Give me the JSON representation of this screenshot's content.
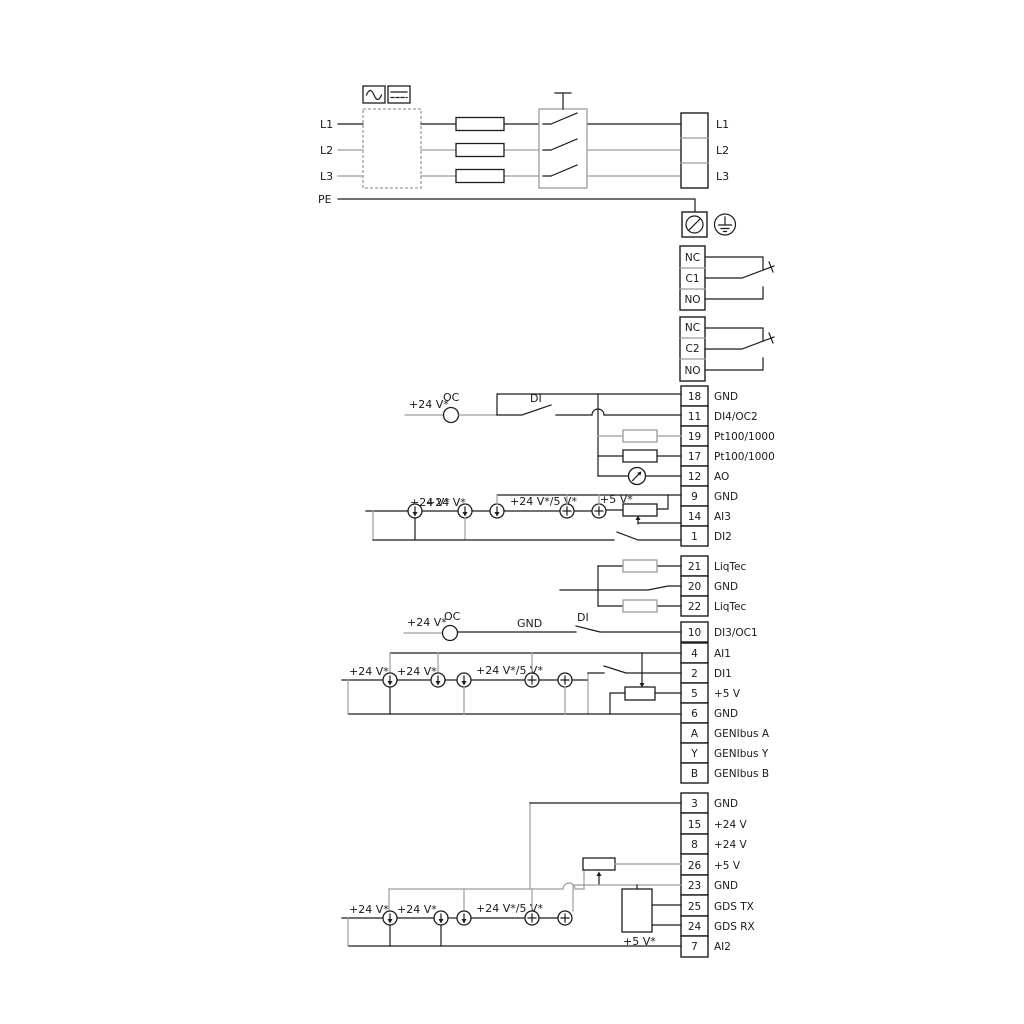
{
  "power": {
    "inputs": [
      "L1",
      "L2",
      "L3"
    ],
    "pe": "PE",
    "outputs": [
      "L1",
      "L2",
      "L3"
    ]
  },
  "relays": [
    {
      "rows": [
        "NC",
        "C1",
        "NO"
      ]
    },
    {
      "rows": [
        "NC",
        "C2",
        "NO"
      ]
    }
  ],
  "terminals": {
    "group1": [
      {
        "num": "18",
        "label": "GND"
      },
      {
        "num": "11",
        "label": "DI4/OC2"
      },
      {
        "num": "19",
        "label": "Pt100/1000"
      },
      {
        "num": "17",
        "label": "Pt100/1000"
      },
      {
        "num": "12",
        "label": "AO"
      },
      {
        "num": "9",
        "label": "GND"
      },
      {
        "num": "14",
        "label": "AI3"
      },
      {
        "num": "1",
        "label": "DI2"
      }
    ],
    "liqtec": [
      {
        "num": "21",
        "label": "LiqTec"
      },
      {
        "num": "20",
        "label": "GND"
      },
      {
        "num": "22",
        "label": "LiqTec"
      }
    ],
    "di3": {
      "num": "10",
      "label": "DI3/OC1"
    },
    "group3": [
      {
        "num": "4",
        "label": "AI1"
      },
      {
        "num": "2",
        "label": "DI1"
      },
      {
        "num": "5",
        "label": "+5 V"
      },
      {
        "num": "6",
        "label": "GND"
      },
      {
        "num": "A",
        "label": "GENIbus A"
      },
      {
        "num": "Y",
        "label": "GENIbus Y"
      },
      {
        "num": "B",
        "label": "GENIbus B"
      }
    ],
    "group4": [
      {
        "num": "3",
        "label": "GND"
      },
      {
        "num": "15",
        "label": "+24 V"
      },
      {
        "num": "8",
        "label": "+24 V"
      },
      {
        "num": "26",
        "label": "+5 V"
      },
      {
        "num": "23",
        "label": "GND"
      },
      {
        "num": "25",
        "label": "GDS TX"
      },
      {
        "num": "24",
        "label": "GDS RX"
      },
      {
        "num": "7",
        "label": "AI2"
      }
    ]
  },
  "annotations": {
    "v24": "+24 V*",
    "v24_5": "+24 V*/5 V*",
    "v5": "+5 V*",
    "oc": "OC",
    "di": "DI",
    "gnd": "GND"
  },
  "colors": {
    "line": "#1c1c1c",
    "gray": "#9c9c9c",
    "background": "#ffffff"
  }
}
